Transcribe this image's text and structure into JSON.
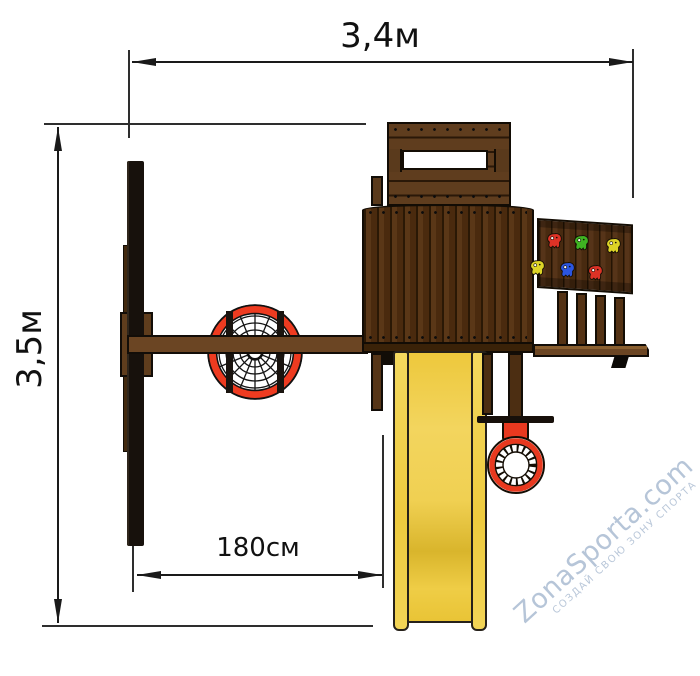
{
  "dimensions": {
    "width": {
      "label": "3,4м"
    },
    "height": {
      "label": "3,5м"
    },
    "offset": {
      "label": "180см"
    }
  },
  "watermark": {
    "brand": "ZonaSporta.com",
    "tagline": "СОЗДАЙ СВОЮ ЗОНУ СПОРТА",
    "color": "#b6c5d8"
  },
  "colors": {
    "dimension_lines": "#1a1a1a",
    "wood_dark": "#4a2a0e",
    "wood_medium": "#6b4523",
    "swing_ring_red": "#ee3b20",
    "slide_yellow": "#eeca3e",
    "hold_red": "#dd3226",
    "hold_green": "#3fb322",
    "hold_yellow": "#ddd427",
    "hold_blue": "#2b55e0"
  }
}
